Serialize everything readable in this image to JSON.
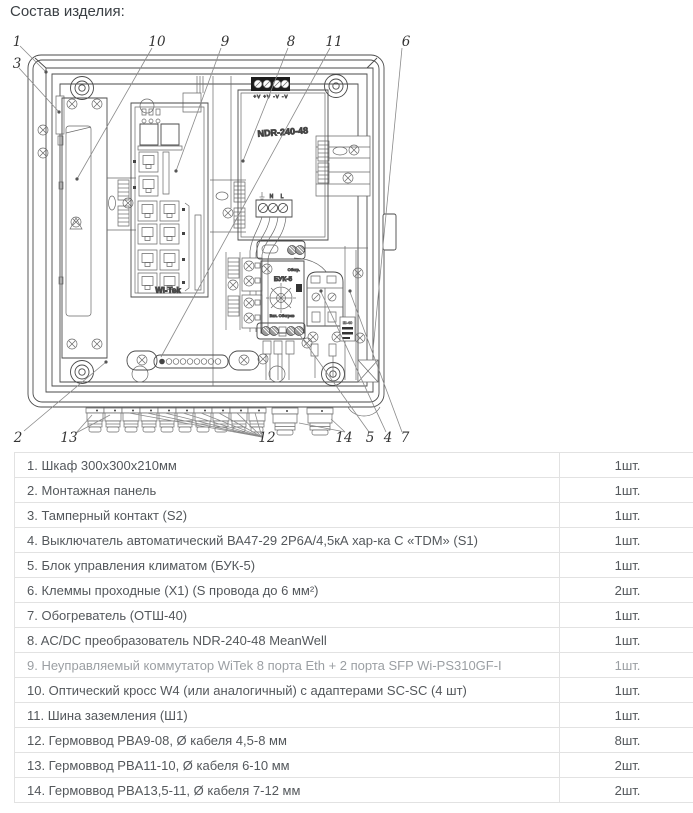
{
  "page": {
    "title": "Состав изделия:"
  },
  "diagram": {
    "callouts": {
      "c1": "1",
      "c2": "2",
      "c3": "3",
      "c4": "4",
      "c5": "5",
      "c6": "6",
      "c7": "7",
      "c8": "8",
      "c9": "9",
      "c10": "10",
      "c11": "11",
      "c12": "12",
      "c13": "13",
      "c14": "14"
    },
    "labels": {
      "psu_model": "NDR-240-48",
      "psu_top_terminals": "+V +V -V -V",
      "psu_input_terminals": "N L",
      "switch_brand": "Wi-Tek",
      "climate_model": "БУК-5",
      "climate_top_text": "Обогр.",
      "climate_bottom_text": "Вкл.  Обогрев",
      "heater_label": "Ш-40"
    }
  },
  "table": {
    "rows": [
      {
        "name": "1. Шкаф 300х300х210мм",
        "qty": "1шт."
      },
      {
        "name": "2. Монтажная панель",
        "qty": "1шт."
      },
      {
        "name": "3. Тамперный контакт (S2)",
        "qty": "1шт."
      },
      {
        "name": "4. Выключатель автоматический ВА47-29 2Р6А/4,5кА хар-ка С «TDM» (S1)",
        "qty": "1шт."
      },
      {
        "name": "5. Блок управления климатом (БУК-5)",
        "qty": "1шт."
      },
      {
        "name": "6. Клеммы проходные (Х1) (S провода до 6 мм²)",
        "qty": "2шт."
      },
      {
        "name": "7. Обогреватель (ОТШ-40)",
        "qty": "1шт."
      },
      {
        "name": "8. AC/DC преобразователь NDR-240-48 MeanWell",
        "qty": "1шт."
      },
      {
        "name": "9. Неуправляемый коммутатор WiTek 8 порта Eth + 2 порта SFP Wi-PS310GF-I",
        "qty": "1шт."
      },
      {
        "name": "10. Оптический кросс W4 (или аналогичный) с адаптерами SC-SC (4 шт)",
        "qty": "1шт."
      },
      {
        "name": "11. Шина заземления (Ш1)",
        "qty": "1шт."
      },
      {
        "name": "12. Гермоввод PBA9-08, Ø кабеля 4,5-8 мм",
        "qty": "8шт."
      },
      {
        "name": "13. Гермоввод PBA11-10, Ø кабеля 6-10 мм",
        "qty": "2шт."
      },
      {
        "name": "14. Гермоввод PBA13,5-11, Ø кабеля 7-12 мм",
        "qty": "2шт."
      }
    ]
  }
}
